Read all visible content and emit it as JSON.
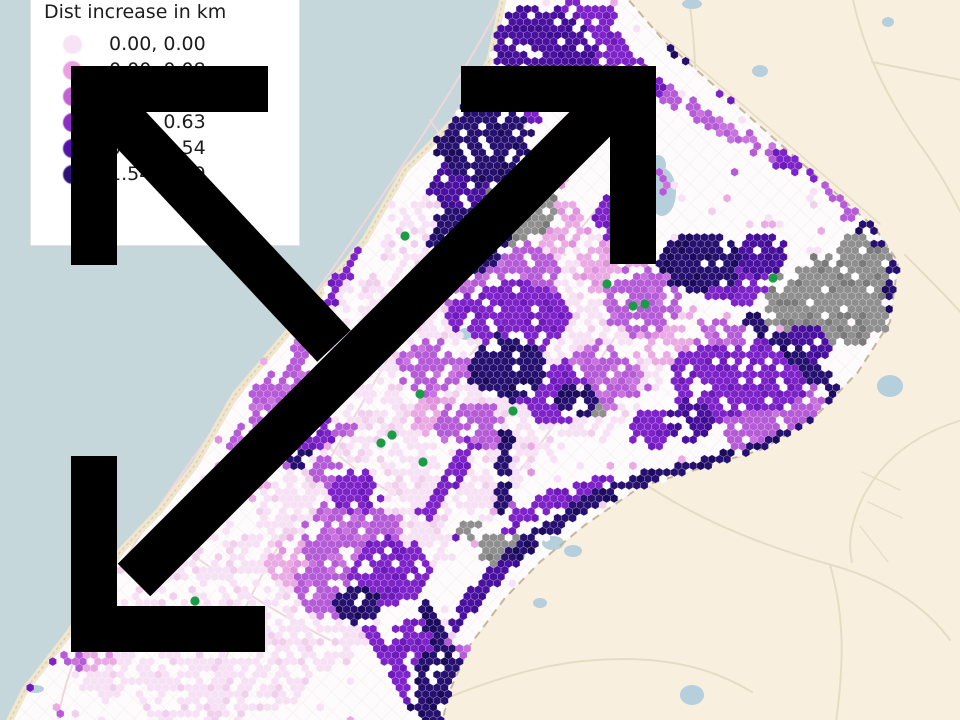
{
  "legend": {
    "title": "Dist increase in km",
    "entries": [
      {
        "label": "0.00, 0.00",
        "color": "#f8e3f6"
      },
      {
        "label": "0.00, 0.08",
        "color": "#ec9fe2"
      },
      {
        "label": "0.08, 0.25",
        "color": "#c263d2"
      },
      {
        "label": "0.25, 0.63",
        "color": "#8e2cc4"
      },
      {
        "label": "0.63, 1.54",
        "color": "#5313a6"
      },
      {
        "label": "1.54, 3.09",
        "color": "#2c1276"
      }
    ]
  },
  "chart_data": {
    "type": "heatmap",
    "subtype": "hexbin-choropleth-map",
    "title": "Dist increase in km",
    "legend_position": "top-left",
    "classes": [
      "0.00, 0.00",
      "0.00, 0.08",
      "0.08, 0.25",
      "0.25, 0.63",
      "0.63, 1.54",
      "1.54, +"
    ],
    "class_colors": [
      "#f8e3f6",
      "#ec9fe2",
      "#c263d2",
      "#8e2cc4",
      "#5313a6",
      "#2c1276"
    ],
    "other_colors": {
      "no_data_gray": "#8f8f8f",
      "poi_green": "#1a9c45"
    }
  },
  "map": {
    "colors": {
      "water": "#c5d7da",
      "outside_land": "#f8efdf",
      "strip_land": "#fdfbfb",
      "sand": "#f0e5cd",
      "sand_line": "#d8cbae",
      "border_dash": "#c3b79e",
      "roads_outside": "#e6dcc6",
      "roads_strip": "#eed7dd",
      "pond": "#b6cfdc",
      "arrow": "#000000",
      "green_dot": "#1a9c45"
    },
    "hex_palette": {
      "main": {
        "1": "#f7e2f5",
        "2": "#eaaae4",
        "3": "#b55bd7",
        "4": "#7e23c9",
        "5": "#4a11a0",
        "6": "#261170",
        "G": "#8f8f8f"
      },
      "alt": {
        "1": "#f1d0ec",
        "2": "#e093dc",
        "3": "#c873de",
        "4": "#6d19bb",
        "5": "#3f0d92",
        "6": "#1c0b5c",
        "G": "#7a7a7a"
      }
    },
    "strip_polygon": [
      [
        505,
        -10
      ],
      [
        620,
        -10
      ],
      [
        665,
        42
      ],
      [
        875,
        228
      ],
      [
        898,
        262
      ],
      [
        890,
        322
      ],
      [
        858,
        372
      ],
      [
        812,
        420
      ],
      [
        760,
        450
      ],
      [
        688,
        472
      ],
      [
        640,
        487
      ],
      [
        585,
        525
      ],
      [
        540,
        562
      ],
      [
        505,
        598
      ],
      [
        470,
        645
      ],
      [
        448,
        695
      ],
      [
        442,
        724
      ],
      [
        8,
        724
      ],
      [
        25,
        690
      ],
      [
        70,
        632
      ],
      [
        120,
        552
      ],
      [
        160,
        510
      ],
      [
        195,
        465
      ],
      [
        235,
        395
      ],
      [
        290,
        330
      ],
      [
        365,
        240
      ],
      [
        405,
        170
      ],
      [
        455,
        120
      ],
      [
        490,
        60
      ]
    ],
    "outside_polygon": [
      [
        620,
        -10
      ],
      [
        966,
        -10
      ],
      [
        966,
        724
      ],
      [
        442,
        724
      ],
      [
        448,
        695
      ],
      [
        470,
        645
      ],
      [
        505,
        598
      ],
      [
        540,
        562
      ],
      [
        585,
        525
      ],
      [
        640,
        487
      ],
      [
        688,
        472
      ],
      [
        760,
        450
      ],
      [
        812,
        420
      ],
      [
        858,
        372
      ],
      [
        890,
        322
      ],
      [
        898,
        262
      ],
      [
        875,
        228
      ],
      [
        665,
        42
      ]
    ],
    "border": [
      [
        620,
        -10
      ],
      [
        665,
        42
      ],
      [
        875,
        228
      ],
      [
        898,
        262
      ],
      [
        890,
        322
      ],
      [
        858,
        372
      ],
      [
        812,
        420
      ],
      [
        760,
        450
      ],
      [
        688,
        472
      ],
      [
        640,
        487
      ],
      [
        585,
        525
      ],
      [
        540,
        562
      ],
      [
        505,
        598
      ],
      [
        470,
        645
      ],
      [
        448,
        695
      ],
      [
        442,
        724
      ]
    ],
    "coast": [
      [
        505,
        -10
      ],
      [
        490,
        60
      ],
      [
        455,
        120
      ],
      [
        405,
        170
      ],
      [
        365,
        240
      ],
      [
        290,
        330
      ],
      [
        235,
        395
      ],
      [
        195,
        465
      ],
      [
        160,
        510
      ],
      [
        120,
        552
      ],
      [
        70,
        632
      ],
      [
        25,
        690
      ],
      [
        8,
        724
      ]
    ],
    "features": {
      "blobs": [
        [
          543,
          52,
          52,
          46,
          "5"
        ],
        [
          580,
          28,
          36,
          26,
          "4"
        ],
        [
          601,
          62,
          28,
          24,
          "4"
        ],
        [
          520,
          95,
          32,
          28,
          "4"
        ],
        [
          483,
          135,
          48,
          50,
          "6"
        ],
        [
          460,
          185,
          30,
          28,
          "5"
        ],
        [
          505,
          200,
          52,
          44,
          "G"
        ],
        [
          468,
          240,
          40,
          34,
          "6"
        ],
        [
          698,
          28,
          40,
          34,
          "6"
        ],
        [
          733,
          62,
          26,
          22,
          "5"
        ],
        [
          748,
          85,
          30,
          26,
          "4"
        ],
        [
          625,
          215,
          30,
          26,
          "4"
        ],
        [
          650,
          182,
          24,
          20,
          "3"
        ],
        [
          562,
          228,
          28,
          24,
          "2"
        ],
        [
          592,
          256,
          26,
          22,
          "1"
        ],
        [
          497,
          278,
          62,
          48,
          "3"
        ],
        [
          522,
          318,
          46,
          36,
          "4"
        ],
        [
          478,
          312,
          28,
          24,
          "4"
        ],
        [
          508,
          368,
          40,
          32,
          "6"
        ],
        [
          556,
          392,
          36,
          30,
          "4"
        ],
        [
          600,
          378,
          42,
          34,
          "3"
        ],
        [
          641,
          300,
          40,
          34,
          "3"
        ],
        [
          610,
          268,
          34,
          28,
          "2"
        ],
        [
          662,
          342,
          28,
          24,
          "2"
        ],
        [
          432,
          368,
          36,
          27,
          "3"
        ],
        [
          468,
          428,
          36,
          27,
          "3"
        ],
        [
          435,
          415,
          26,
          21,
          "2"
        ],
        [
          520,
          345,
          145,
          105,
          "1"
        ],
        [
          430,
          445,
          105,
          82,
          "1"
        ],
        [
          350,
          525,
          100,
          82,
          "1"
        ],
        [
          295,
          595,
          92,
          72,
          "1"
        ],
        [
          240,
          655,
          82,
          58,
          "1"
        ],
        [
          455,
          248,
          72,
          52,
          "1"
        ],
        [
          380,
          330,
          66,
          52,
          "1"
        ],
        [
          200,
          690,
          66,
          42,
          "1"
        ],
        [
          585,
          302,
          60,
          46,
          "1"
        ],
        [
          110,
          672,
          38,
          28,
          "1"
        ],
        [
          577,
          400,
          20,
          17,
          "6"
        ],
        [
          592,
          408,
          13,
          11,
          "G"
        ],
        [
          652,
          428,
          24,
          20,
          "4"
        ],
        [
          700,
          262,
          40,
          30,
          "6"
        ],
        [
          733,
          282,
          34,
          26,
          "4"
        ],
        [
          760,
          255,
          26,
          21,
          "5"
        ],
        [
          832,
          302,
          66,
          46,
          "G"
        ],
        [
          868,
          258,
          38,
          24,
          "G"
        ],
        [
          878,
          238,
          15,
          11,
          "G"
        ],
        [
          718,
          382,
          48,
          40,
          "4"
        ],
        [
          768,
          375,
          40,
          36,
          "4"
        ],
        [
          798,
          408,
          30,
          25,
          "3"
        ],
        [
          758,
          430,
          34,
          24,
          "3"
        ],
        [
          720,
          340,
          28,
          22,
          "3"
        ],
        [
          690,
          420,
          26,
          20,
          "5"
        ],
        [
          805,
          345,
          26,
          20,
          "5"
        ],
        [
          352,
          540,
          52,
          44,
          "3"
        ],
        [
          390,
          572,
          40,
          34,
          "4"
        ],
        [
          330,
          588,
          34,
          30,
          "3"
        ],
        [
          358,
          605,
          24,
          18,
          "6"
        ],
        [
          302,
          560,
          34,
          28,
          "2"
        ],
        [
          355,
          490,
          26,
          22,
          "4"
        ],
        [
          330,
          470,
          20,
          16,
          "3"
        ],
        [
          420,
          642,
          30,
          25,
          "4"
        ],
        [
          441,
          672,
          26,
          22,
          "6"
        ],
        [
          453,
          700,
          25,
          21,
          "4"
        ],
        [
          430,
          702,
          21,
          17,
          "6"
        ],
        [
          478,
          662,
          25,
          21,
          "3"
        ],
        [
          290,
          402,
          38,
          34,
          "3"
        ],
        [
          265,
          445,
          34,
          30,
          "3"
        ],
        [
          242,
          478,
          28,
          24,
          "2"
        ],
        [
          310,
          430,
          25,
          20,
          "4"
        ],
        [
          300,
          458,
          12,
          10,
          "6"
        ],
        [
          180,
          562,
          28,
          20,
          "1"
        ],
        [
          150,
          602,
          26,
          19,
          "1"
        ],
        [
          218,
          600,
          34,
          24,
          "1"
        ],
        [
          200,
          522,
          30,
          21,
          "1"
        ],
        [
          97,
          658,
          19,
          15,
          "2"
        ],
        [
          74,
          660,
          13,
          10,
          "3"
        ],
        [
          340,
          432,
          15,
          12,
          "3"
        ],
        [
          500,
          548,
          24,
          17,
          "G"
        ],
        [
          470,
          530,
          12,
          9,
          "G"
        ]
      ],
      "chains": [
        [
          608,
          35,
          658,
          88,
          "4",
          8
        ],
        [
          658,
          88,
          725,
          130,
          "3",
          8
        ],
        [
          725,
          130,
          780,
          158,
          "3",
          8
        ],
        [
          780,
          158,
          822,
          175,
          "4",
          8
        ],
        [
          822,
          175,
          858,
          222,
          "3",
          8
        ],
        [
          612,
          12,
          568,
          92,
          "4",
          8
        ],
        [
          858,
          226,
          900,
          248,
          "6",
          8
        ],
        [
          900,
          248,
          892,
          302,
          "6",
          8
        ],
        [
          750,
          322,
          806,
          364,
          "6",
          8
        ],
        [
          806,
          364,
          852,
          410,
          "6",
          8
        ],
        [
          852,
          410,
          782,
          442,
          "6",
          8
        ],
        [
          782,
          442,
          700,
          468,
          "6",
          8
        ],
        [
          700,
          468,
          620,
          486,
          "6",
          8
        ],
        [
          620,
          486,
          560,
          520,
          "6",
          8
        ],
        [
          560,
          520,
          512,
          556,
          "6",
          8
        ],
        [
          512,
          556,
          480,
          590,
          "5",
          8
        ],
        [
          480,
          590,
          455,
          625,
          "5",
          8
        ],
        [
          427,
          610,
          445,
          652,
          "6",
          8
        ],
        [
          445,
          652,
          430,
          700,
          "6",
          8
        ],
        [
          430,
          700,
          435,
          722,
          "6",
          8
        ],
        [
          618,
          480,
          548,
          500,
          "4",
          8
        ],
        [
          548,
          500,
          508,
          526,
          "4",
          8
        ],
        [
          505,
          438,
          502,
          508,
          "6",
          7
        ],
        [
          412,
          142,
          362,
          238,
          "4",
          8
        ],
        [
          362,
          238,
          322,
          308,
          "4",
          8
        ],
        [
          322,
          308,
          292,
          372,
          "3",
          8
        ],
        [
          448,
          98,
          415,
          148,
          "6",
          8
        ],
        [
          470,
          448,
          425,
          515,
          "4",
          8
        ],
        [
          560,
          556,
          545,
          600,
          "4",
          7
        ],
        [
          370,
          635,
          395,
          668,
          "4",
          8
        ],
        [
          395,
          668,
          408,
          700,
          "4",
          8
        ]
      ]
    },
    "green_dots": [
      [
        405,
        236
      ],
      [
        607,
        284
      ],
      [
        633,
        306
      ],
      [
        645,
        304
      ],
      [
        773,
        278
      ],
      [
        420,
        394
      ],
      [
        392,
        435
      ],
      [
        381,
        443
      ],
      [
        423,
        462
      ],
      [
        513,
        411
      ],
      [
        195,
        601
      ]
    ],
    "ponds_strip": [
      [
        662,
        192,
        14,
        24
      ],
      [
        658,
        165,
        8,
        10
      ],
      [
        692,
        4,
        10,
        5
      ],
      [
        466,
        334,
        8,
        6
      ],
      [
        553,
        543,
        11,
        7
      ],
      [
        573,
        551,
        9,
        6
      ],
      [
        540,
        603,
        7,
        5
      ],
      [
        520,
        556,
        5,
        4
      ],
      [
        502,
        413,
        5,
        4
      ],
      [
        35,
        689,
        9,
        4
      ]
    ],
    "ponds_outside": [
      [
        890,
        386,
        13,
        11
      ],
      [
        692,
        695,
        12,
        10
      ],
      [
        760,
        71,
        8,
        6
      ],
      [
        888,
        22,
        6,
        5
      ]
    ]
  }
}
